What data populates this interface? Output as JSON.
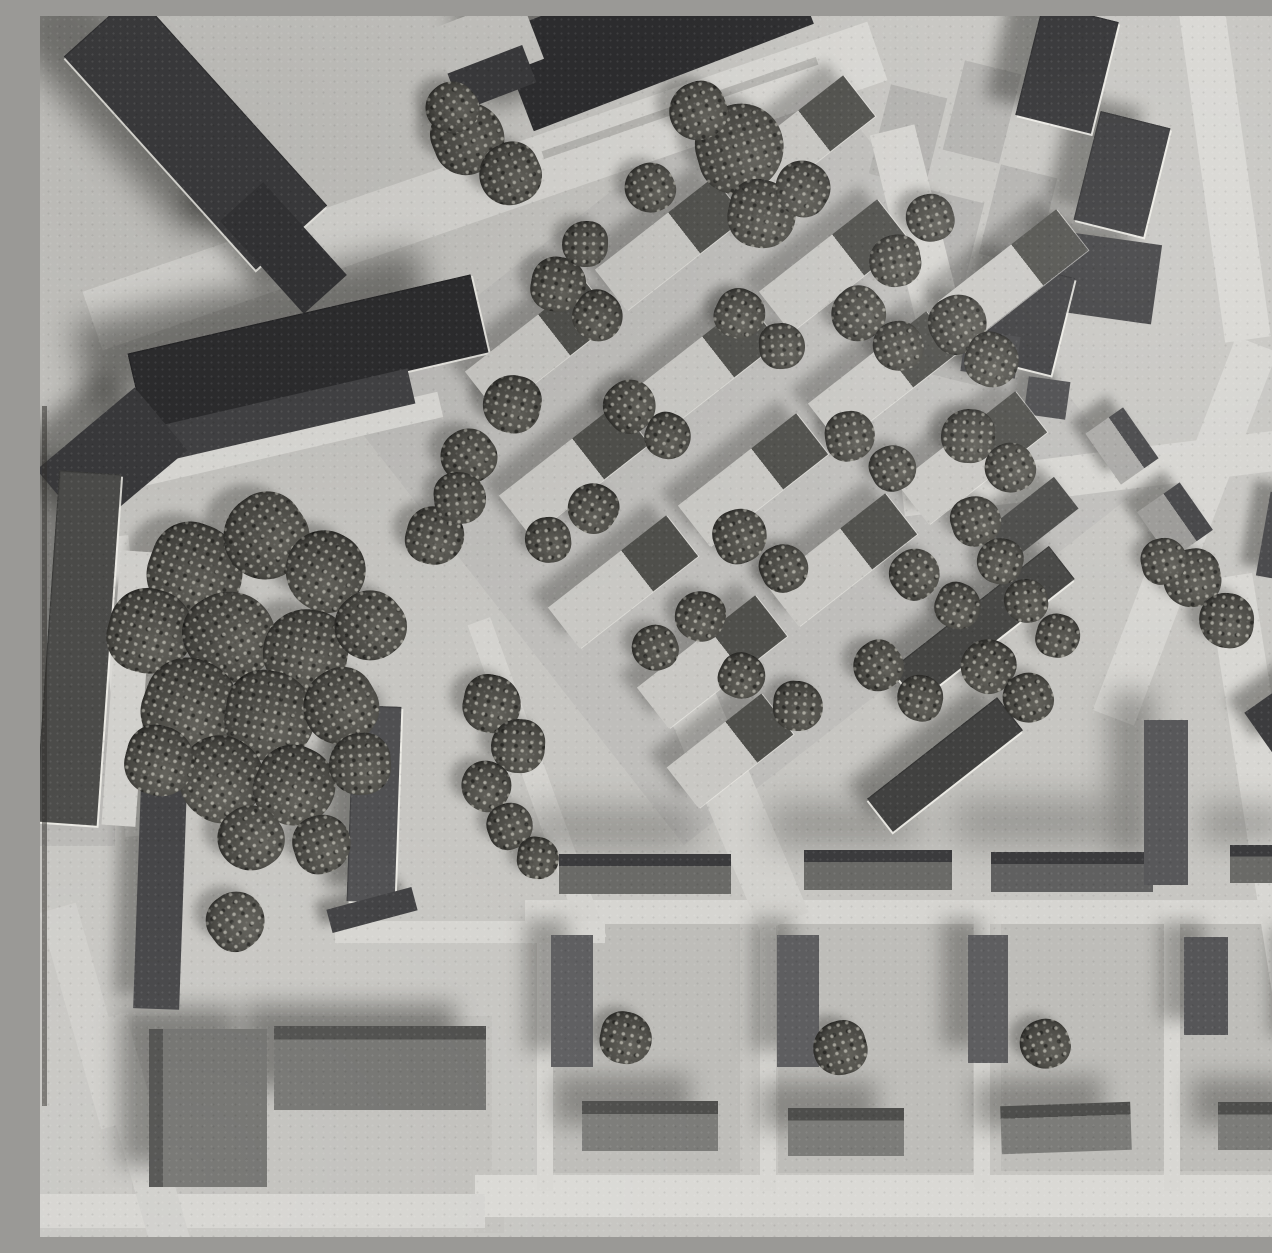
{
  "scene": {
    "description": "Black-and-white aerial photograph of an architectural scale model: diagonal rows of terrace houses with trees in the center, dark slab buildings at the top left and top right, a tree grove on the left, an orthogonal housing grid with courtyards at the bottom, and light roads crossing the site.",
    "palette": {
      "ground": "#c7c6c2",
      "road_light": "#d9d8d4",
      "plot_gray": "#b2b1ae",
      "building_dark": "#2c2c2e",
      "building_mid": "#5e5e60",
      "roof_light": "#c9c8c4",
      "tree_dark": "#45443f",
      "shadow": "#232320"
    }
  },
  "ground": [
    {
      "x": 700,
      "y": 430,
      "w": 580,
      "h": 560,
      "r": -38,
      "c": "#bfbebb"
    },
    {
      "x": 35,
      "y": 635,
      "w": 80,
      "h": 390,
      "r": 0,
      "c": "#bab9b6"
    },
    {
      "x": 272,
      "y": 1090,
      "w": 360,
      "h": 180,
      "r": 0,
      "c": "#c1c0bc"
    },
    {
      "x": 605,
      "y": 1032,
      "w": 190,
      "h": 250,
      "r": 0,
      "c": "#bebdb9"
    },
    {
      "x": 835,
      "y": 1032,
      "w": 195,
      "h": 250,
      "r": 0,
      "c": "#bebdb9"
    },
    {
      "x": 1048,
      "y": 1030,
      "w": 175,
      "h": 250,
      "r": 0,
      "c": "#bebdb9"
    },
    {
      "x": 1215,
      "y": 1030,
      "w": 160,
      "h": 250,
      "r": 0,
      "c": "#bebdb9"
    },
    {
      "x": 868,
      "y": 120,
      "w": 58,
      "h": 92,
      "r": 14,
      "c": "#b2b1ae"
    },
    {
      "x": 942,
      "y": 96,
      "w": 58,
      "h": 92,
      "r": 14,
      "c": "#b2b1ae"
    },
    {
      "x": 905,
      "y": 225,
      "w": 58,
      "h": 92,
      "r": 14,
      "c": "#b2b1ae"
    },
    {
      "x": 978,
      "y": 200,
      "w": 58,
      "h": 92,
      "r": 14,
      "c": "#b2b1ae"
    },
    {
      "x": 920,
      "y": 318,
      "w": 58,
      "h": 92,
      "r": 14,
      "c": "#b2b1ae"
    },
    {
      "x": 993,
      "y": 293,
      "w": 58,
      "h": 92,
      "r": 14,
      "c": "#b2b1ae"
    },
    {
      "x": 447,
      "y": 1167,
      "w": 28,
      "h": 26,
      "r": 0,
      "c": "#c3c2be"
    },
    {
      "x": 449,
      "y": 1205,
      "w": 30,
      "h": 24,
      "r": 0,
      "c": "#c3c2be"
    }
  ],
  "roads": [
    {
      "x": 445,
      "y": 170,
      "w": 830,
      "h": 62,
      "r": -19,
      "c": "#d9d8d4"
    },
    {
      "x": 640,
      "y": 92,
      "w": 290,
      "h": 8,
      "r": -19,
      "c": "#b8b7b3"
    },
    {
      "x": 1071,
      "y": 455,
      "w": 420,
      "h": 40,
      "r": -7,
      "c": "#d6d5d1"
    },
    {
      "x": 1145,
      "y": 515,
      "w": 400,
      "h": 44,
      "r": -69,
      "c": "#d6d5d1"
    },
    {
      "x": 1226,
      "y": 795,
      "w": 475,
      "h": 46,
      "r": 81,
      "c": "#d8d7d3"
    },
    {
      "x": 1185,
      "y": 160,
      "w": 330,
      "h": 46,
      "r": 82,
      "c": "#d8d7d3"
    },
    {
      "x": 880,
      "y": 228,
      "w": 235,
      "h": 46,
      "r": 76,
      "c": "#d5d4d0"
    },
    {
      "x": 855,
      "y": 1180,
      "w": 840,
      "h": 42,
      "r": 0,
      "c": "#dad9d5"
    },
    {
      "x": 220,
      "y": 1195,
      "w": 450,
      "h": 34,
      "r": 0,
      "c": "#d5d4d0"
    },
    {
      "x": 880,
      "y": 896,
      "w": 790,
      "h": 24,
      "r": 0,
      "c": "#d6d5d1"
    },
    {
      "x": 505,
      "y": 1030,
      "w": 16,
      "h": 290,
      "r": 0,
      "c": "#d8d7d3"
    },
    {
      "x": 728,
      "y": 1030,
      "w": 16,
      "h": 290,
      "r": 0,
      "c": "#d8d7d3"
    },
    {
      "x": 942,
      "y": 1030,
      "w": 16,
      "h": 290,
      "r": 0,
      "c": "#d8d7d3"
    },
    {
      "x": 1132,
      "y": 1030,
      "w": 16,
      "h": 290,
      "r": 0,
      "c": "#d8d7d3"
    },
    {
      "x": 497,
      "y": 765,
      "w": 340,
      "h": 24,
      "r": 70,
      "c": "#d4d3cf"
    },
    {
      "x": 692,
      "y": 782,
      "w": 270,
      "h": 52,
      "r": 67,
      "c": "#d2d1cd"
    },
    {
      "x": 430,
      "y": 916,
      "w": 270,
      "h": 22,
      "r": 0,
      "c": "#d6d5d1"
    },
    {
      "x": 87,
      "y": 670,
      "w": 300,
      "h": 34,
      "r": 84,
      "c": "#d9d8d4"
    },
    {
      "x": 48,
      "y": 1000,
      "w": 225,
      "h": 38,
      "r": 74,
      "c": "#cfceca"
    },
    {
      "x": 98,
      "y": 1115,
      "w": 235,
      "h": 40,
      "r": 74,
      "c": "#cfceca"
    },
    {
      "x": 220,
      "y": 430,
      "w": 370,
      "h": 26,
      "r": -13,
      "c": "#dcdbd7"
    }
  ],
  "buildings": [
    {
      "x": 155,
      "y": 115,
      "w": 287,
      "h": 96,
      "r": 48,
      "c": "#3a3a3c",
      "edge": 1,
      "sh": [
        -65,
        -30,
        16,
        0.5
      ]
    },
    {
      "x": 243,
      "y": 232,
      "w": 125,
      "h": 58,
      "r": 48,
      "c": "#323234",
      "sh": [
        -40,
        -20,
        10,
        0.45
      ]
    },
    {
      "x": 615,
      "y": 12,
      "w": 300,
      "h": 105,
      "r": -21,
      "c": "#2c2c2e",
      "sh": [
        -45,
        -22,
        12,
        0.5
      ]
    },
    {
      "x": 447,
      "y": 28,
      "w": 95,
      "h": 68,
      "r": -21,
      "c": "#c7c6c2"
    },
    {
      "x": 452,
      "y": 62,
      "w": 80,
      "h": 40,
      "r": -21,
      "c": "#39393b"
    },
    {
      "x": 1027,
      "y": 52,
      "w": 78,
      "h": 115,
      "r": 14,
      "c": "#323234",
      "edge": 1,
      "sh": [
        -30,
        -18,
        8,
        0.45
      ]
    },
    {
      "x": 1082,
      "y": 158,
      "w": 72,
      "h": 112,
      "r": 14,
      "c": "#38383a",
      "edge": 1,
      "sh": [
        -28,
        -18,
        8,
        0.45
      ]
    },
    {
      "x": 1068,
      "y": 262,
      "w": 98,
      "h": 80,
      "r": 8,
      "c": "#3e3e40",
      "sh": [
        -30,
        -20,
        10,
        0.45
      ]
    },
    {
      "x": 988,
      "y": 302,
      "w": 72,
      "h": 100,
      "r": 14,
      "c": "#3c3c3e",
      "edge": 1,
      "sh": [
        -26,
        -16,
        8,
        0.45
      ]
    },
    {
      "x": 950,
      "y": 338,
      "w": 55,
      "h": 42,
      "r": 8,
      "c": "#464648",
      "sh": [
        -18,
        -12,
        6,
        0.4
      ]
    },
    {
      "x": 1007,
      "y": 382,
      "w": 42,
      "h": 38,
      "r": 8,
      "c": "#4a4a4c",
      "sh": [
        -14,
        -10,
        5,
        0.4
      ]
    },
    {
      "x": 1082,
      "y": 430,
      "w": 46,
      "h": 62,
      "r": -35,
      "two": [
        "#a9a8a5",
        "#454547"
      ],
      "sh": [
        -16,
        -12,
        5,
        0.4
      ]
    },
    {
      "x": 953,
      "y": 442,
      "w": 46,
      "h": 30,
      "r": 8,
      "c": "#505052",
      "sh": [
        -12,
        -9,
        4,
        0.35
      ]
    },
    {
      "x": 1135,
      "y": 505,
      "w": 52,
      "h": 58,
      "r": -35,
      "two": [
        "#9a9996",
        "#434345"
      ],
      "sh": [
        -16,
        -12,
        5,
        0.4
      ]
    },
    {
      "x": 1240,
      "y": 520,
      "w": 34,
      "h": 85,
      "r": 10,
      "c": "#48484a",
      "sh": [
        -16,
        -12,
        5,
        0.4
      ]
    },
    {
      "x": 1250,
      "y": 694,
      "w": 78,
      "h": 48,
      "r": -35,
      "c": "#3c3c3e",
      "sh": [
        -18,
        -14,
        6,
        0.4
      ]
    },
    {
      "x": 268,
      "y": 337,
      "w": 352,
      "h": 80,
      "r": -13,
      "c": "#2b2b2d",
      "edge": 1,
      "sh": [
        -55,
        -28,
        16,
        0.5
      ]
    },
    {
      "x": 232,
      "y": 402,
      "w": 285,
      "h": 36,
      "r": -13,
      "c": "#414143",
      "sh": [
        -25,
        -15,
        8,
        0.4
      ]
    },
    {
      "x": 72,
      "y": 444,
      "w": 128,
      "h": 82,
      "r": -40,
      "c": "#39393b",
      "sh": [
        -30,
        -18,
        10,
        0.45
      ]
    },
    {
      "x": 38,
      "y": 632,
      "w": 62,
      "h": 352,
      "r": 4,
      "c": "#4b4b49",
      "edge": 1,
      "sh": [
        -22,
        -14,
        10,
        0.4
      ]
    },
    {
      "x": 88,
      "y": 672,
      "w": 34,
      "h": 275,
      "r": 4,
      "c": "#d2d1cd"
    },
    {
      "x": 120,
      "y": 882,
      "w": 46,
      "h": 222,
      "r": 2,
      "c": "#424244",
      "sh": [
        -20,
        -13,
        8,
        0.4
      ]
    },
    {
      "x": 334,
      "y": 788,
      "w": 48,
      "h": 196,
      "r": 2,
      "c": "#4f4f51",
      "edge": 1,
      "sh": [
        -22,
        -14,
        8,
        0.45
      ]
    },
    {
      "x": 332,
      "y": 894,
      "w": 88,
      "h": 24,
      "r": -15,
      "c": "#3f3f41",
      "sh": [
        -12,
        -8,
        5,
        0.4
      ]
    },
    {
      "x": 168,
      "y": 1092,
      "w": 118,
      "h": 158,
      "r": 0,
      "g": [
        90,
        "#4c4c4a",
        12,
        "#6f6f6c"
      ],
      "sh": [
        -30,
        -22,
        12,
        0.45
      ]
    },
    {
      "x": 340,
      "y": 1052,
      "w": 212,
      "h": 84,
      "r": 0,
      "g": [
        180,
        "#4c4c4a",
        16,
        "#72726f"
      ],
      "sh": [
        -30,
        -22,
        12,
        0.45
      ]
    },
    {
      "x": 605,
      "y": 858,
      "w": 172,
      "h": 40,
      "r": 0,
      "g": [
        180,
        "#3b3b3d",
        30,
        "#6a6a67"
      ],
      "sh": [
        -35,
        -45,
        18,
        0.32
      ]
    },
    {
      "x": 838,
      "y": 854,
      "w": 148,
      "h": 40,
      "r": 0,
      "g": [
        180,
        "#3b3b3d",
        30,
        "#6a6a67"
      ],
      "sh": [
        -35,
        -45,
        18,
        0.32
      ]
    },
    {
      "x": 1032,
      "y": 856,
      "w": 162,
      "h": 40,
      "r": 0,
      "g": [
        180,
        "#3b3b3d",
        30,
        "#606060"
      ],
      "sh": [
        -40,
        -50,
        20,
        0.34
      ]
    },
    {
      "x": 1234,
      "y": 848,
      "w": 88,
      "h": 38,
      "r": 0,
      "g": [
        180,
        "#3b3b3d",
        30,
        "#6a6a67"
      ],
      "sh": [
        -30,
        -40,
        16,
        0.3
      ]
    },
    {
      "x": 1126,
      "y": 786,
      "w": 44,
      "h": 165,
      "r": 0,
      "c": "#58585a",
      "sh": [
        -35,
        -28,
        14,
        0.35
      ]
    },
    {
      "x": 532,
      "y": 985,
      "w": 42,
      "h": 132,
      "r": 0,
      "c": "#5e5e60",
      "sh": [
        -26,
        -16,
        10,
        0.35
      ]
    },
    {
      "x": 758,
      "y": 985,
      "w": 42,
      "h": 132,
      "r": 0,
      "c": "#5e5e60",
      "sh": [
        -26,
        -16,
        10,
        0.35
      ]
    },
    {
      "x": 948,
      "y": 983,
      "w": 40,
      "h": 128,
      "r": 0,
      "c": "#5e5e60",
      "sh": [
        -26,
        -16,
        10,
        0.35
      ]
    },
    {
      "x": 1166,
      "y": 970,
      "w": 44,
      "h": 98,
      "r": 0,
      "c": "#565658",
      "sh": [
        -24,
        -15,
        9,
        0.35
      ]
    },
    {
      "x": 1264,
      "y": 978,
      "w": 30,
      "h": 108,
      "r": 0,
      "c": "#5a5a5c",
      "sh": [
        -20,
        -13,
        8,
        0.35
      ]
    },
    {
      "x": 610,
      "y": 1110,
      "w": 136,
      "h": 50,
      "r": 0,
      "g": [
        180,
        "#4e4e4c",
        26,
        "#7c7c79"
      ],
      "sh": [
        -28,
        -26,
        12,
        0.35
      ]
    },
    {
      "x": 806,
      "y": 1116,
      "w": 116,
      "h": 48,
      "r": 0,
      "g": [
        180,
        "#4e4e4c",
        26,
        "#7c7c79"
      ],
      "sh": [
        -28,
        -26,
        12,
        0.35
      ]
    },
    {
      "x": 1026,
      "y": 1112,
      "w": 130,
      "h": 48,
      "r": -2,
      "g": [
        180,
        "#4e4e4c",
        26,
        "#7c7c79"
      ],
      "sh": [
        -28,
        -26,
        12,
        0.35
      ]
    },
    {
      "x": 1226,
      "y": 1110,
      "w": 96,
      "h": 48,
      "r": 0,
      "g": [
        180,
        "#4e4e4c",
        26,
        "#7c7c79"
      ],
      "sh": [
        -26,
        -24,
        12,
        0.35
      ]
    },
    {
      "x": 943,
      "y": 608,
      "w": 42,
      "h": 200,
      "r": 52,
      "c": "#454543",
      "edge": 1,
      "sh": [
        -20,
        -15,
        8,
        0.4
      ]
    },
    {
      "x": 905,
      "y": 748,
      "w": 42,
      "h": 165,
      "r": 52,
      "c": "#414140",
      "edge": 1,
      "sh": [
        -20,
        -15,
        8,
        0.4
      ]
    },
    {
      "x": 990,
      "y": 505,
      "w": 40,
      "h": 92,
      "r": 52,
      "c": "#4a4a48",
      "sh": [
        -16,
        -12,
        6,
        0.4
      ]
    }
  ],
  "estate_houses": [
    {
      "x": 500,
      "y": 330
    },
    {
      "x": 630,
      "y": 228
    },
    {
      "x": 760,
      "y": 126
    },
    {
      "x": 534,
      "y": 454
    },
    {
      "x": 664,
      "y": 352
    },
    {
      "x": 794,
      "y": 250
    },
    {
      "x": 583,
      "y": 566
    },
    {
      "x": 713,
      "y": 464
    },
    {
      "x": 843,
      "y": 362
    },
    {
      "x": 973,
      "y": 260
    },
    {
      "x": 672,
      "y": 646
    },
    {
      "x": 802,
      "y": 544
    },
    {
      "x": 932,
      "y": 442
    },
    {
      "x": 690,
      "y": 735,
      "w": 120
    }
  ],
  "estate_house_style": {
    "w": 150,
    "h": 52,
    "r": -38,
    "light": "#c9c8c4",
    "dark": "#4f4f4b",
    "split": 62
  },
  "trees": [
    {
      "x": 155,
      "y": 555,
      "d": 95
    },
    {
      "x": 225,
      "y": 520,
      "d": 85
    },
    {
      "x": 285,
      "y": 555,
      "d": 80
    },
    {
      "x": 110,
      "y": 615,
      "d": 85
    },
    {
      "x": 190,
      "y": 620,
      "d": 90
    },
    {
      "x": 265,
      "y": 635,
      "d": 85
    },
    {
      "x": 330,
      "y": 610,
      "d": 70
    },
    {
      "x": 150,
      "y": 690,
      "d": 95
    },
    {
      "x": 230,
      "y": 700,
      "d": 90
    },
    {
      "x": 300,
      "y": 690,
      "d": 75
    },
    {
      "x": 180,
      "y": 762,
      "d": 85
    },
    {
      "x": 255,
      "y": 770,
      "d": 80
    },
    {
      "x": 120,
      "y": 745,
      "d": 70
    },
    {
      "x": 320,
      "y": 748,
      "d": 62
    },
    {
      "x": 210,
      "y": 822,
      "d": 65
    },
    {
      "x": 282,
      "y": 828,
      "d": 58
    },
    {
      "x": 428,
      "y": 122,
      "d": 72
    },
    {
      "x": 470,
      "y": 158,
      "d": 62
    },
    {
      "x": 412,
      "y": 92,
      "d": 52
    },
    {
      "x": 700,
      "y": 132,
      "d": 88
    },
    {
      "x": 722,
      "y": 198,
      "d": 68
    },
    {
      "x": 658,
      "y": 95,
      "d": 58
    },
    {
      "x": 762,
      "y": 172,
      "d": 55
    },
    {
      "x": 518,
      "y": 268,
      "d": 55
    },
    {
      "x": 558,
      "y": 300,
      "d": 50
    },
    {
      "x": 472,
      "y": 388,
      "d": 58
    },
    {
      "x": 428,
      "y": 440,
      "d": 55
    },
    {
      "x": 395,
      "y": 520,
      "d": 58
    },
    {
      "x": 420,
      "y": 482,
      "d": 52
    },
    {
      "x": 545,
      "y": 228,
      "d": 46
    },
    {
      "x": 610,
      "y": 172,
      "d": 50
    },
    {
      "x": 590,
      "y": 390,
      "d": 52
    },
    {
      "x": 628,
      "y": 420,
      "d": 46
    },
    {
      "x": 553,
      "y": 492,
      "d": 50
    },
    {
      "x": 508,
      "y": 524,
      "d": 46
    },
    {
      "x": 700,
      "y": 298,
      "d": 50
    },
    {
      "x": 742,
      "y": 330,
      "d": 46
    },
    {
      "x": 818,
      "y": 298,
      "d": 54
    },
    {
      "x": 858,
      "y": 330,
      "d": 50
    },
    {
      "x": 918,
      "y": 308,
      "d": 58
    },
    {
      "x": 952,
      "y": 344,
      "d": 54
    },
    {
      "x": 855,
      "y": 245,
      "d": 52
    },
    {
      "x": 890,
      "y": 202,
      "d": 48
    },
    {
      "x": 700,
      "y": 520,
      "d": 54
    },
    {
      "x": 744,
      "y": 552,
      "d": 48
    },
    {
      "x": 660,
      "y": 600,
      "d": 50
    },
    {
      "x": 615,
      "y": 632,
      "d": 46
    },
    {
      "x": 810,
      "y": 420,
      "d": 50
    },
    {
      "x": 853,
      "y": 452,
      "d": 46
    },
    {
      "x": 928,
      "y": 420,
      "d": 54
    },
    {
      "x": 970,
      "y": 452,
      "d": 50
    },
    {
      "x": 875,
      "y": 558,
      "d": 50
    },
    {
      "x": 918,
      "y": 590,
      "d": 46
    },
    {
      "x": 838,
      "y": 650,
      "d": 50
    },
    {
      "x": 880,
      "y": 682,
      "d": 46
    },
    {
      "x": 702,
      "y": 660,
      "d": 46
    },
    {
      "x": 758,
      "y": 690,
      "d": 50
    },
    {
      "x": 948,
      "y": 650,
      "d": 54
    },
    {
      "x": 988,
      "y": 682,
      "d": 50
    },
    {
      "x": 1018,
      "y": 620,
      "d": 44
    },
    {
      "x": 452,
      "y": 688,
      "d": 58
    },
    {
      "x": 478,
      "y": 730,
      "d": 54
    },
    {
      "x": 446,
      "y": 770,
      "d": 50
    },
    {
      "x": 470,
      "y": 810,
      "d": 46
    },
    {
      "x": 498,
      "y": 842,
      "d": 42
    },
    {
      "x": 1152,
      "y": 562,
      "d": 58
    },
    {
      "x": 1186,
      "y": 604,
      "d": 55
    },
    {
      "x": 1124,
      "y": 545,
      "d": 46
    },
    {
      "x": 936,
      "y": 505,
      "d": 50
    },
    {
      "x": 960,
      "y": 545,
      "d": 46
    },
    {
      "x": 986,
      "y": 585,
      "d": 44
    },
    {
      "x": 196,
      "y": 905,
      "d": 58
    },
    {
      "x": 586,
      "y": 1022,
      "d": 52
    },
    {
      "x": 800,
      "y": 1032,
      "d": 54
    },
    {
      "x": 1005,
      "y": 1028,
      "d": 50
    }
  ],
  "marks": [
    {
      "x": 2,
      "y": 740,
      "w": 5,
      "h": 700,
      "name": "film-edge-line"
    }
  ]
}
